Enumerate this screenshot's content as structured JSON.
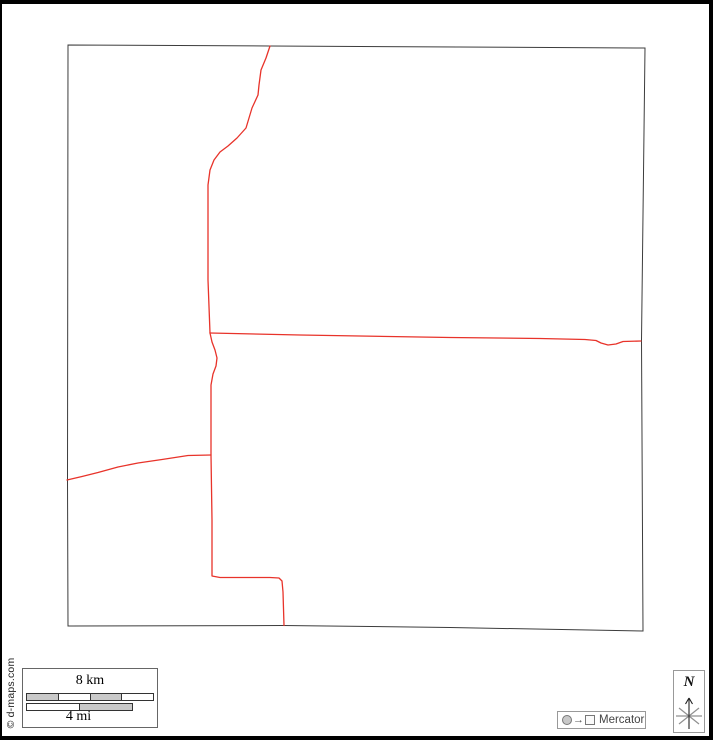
{
  "page": {
    "background": "#ffffff",
    "frame_color": "#000000"
  },
  "map": {
    "boundary_color": "#3c3c3c",
    "road_color": "#e8332a",
    "boundary_points": "68,45 270,46 645,48 641.5,340 643,631 450,627.5 283,625.5 68,626 67.5,480",
    "roads": [
      {
        "name": "north-road",
        "points": "270,46 266,58 261,70 259,85 258,95 252,108 249,118 246,128 237,138 228,146 220,152 214,160 210,170 208,185 208,280 210,333"
      },
      {
        "name": "east-road",
        "points": "210,333 300,335 450,337.5 540,338.5 585,339.5 596,340.5 601,343 608,345 616,344 623,341.5 641,341"
      },
      {
        "name": "south-road",
        "points": "210,333 212,342 215,350 217,358 216,366 213,374 211,385 211,455 212,520 212,576 220,577.5 270,577.5 279,578 282,581 283,592 284,625.5"
      },
      {
        "name": "west-road",
        "points": "67,480 82,476.5 98,472.5 118,467 138,463 162,459.5 188,455.5 211,455"
      }
    ]
  },
  "scale_bar": {
    "km_label": "8 km",
    "mi_label": "4 mi",
    "bar_fill_gray": "#c9c9c9",
    "bar_fill_white": "#ffffff"
  },
  "projection": {
    "arrow": "→",
    "label": "Mercator"
  },
  "compass": {
    "north_label": "N"
  },
  "copyright": "© d-maps.com"
}
